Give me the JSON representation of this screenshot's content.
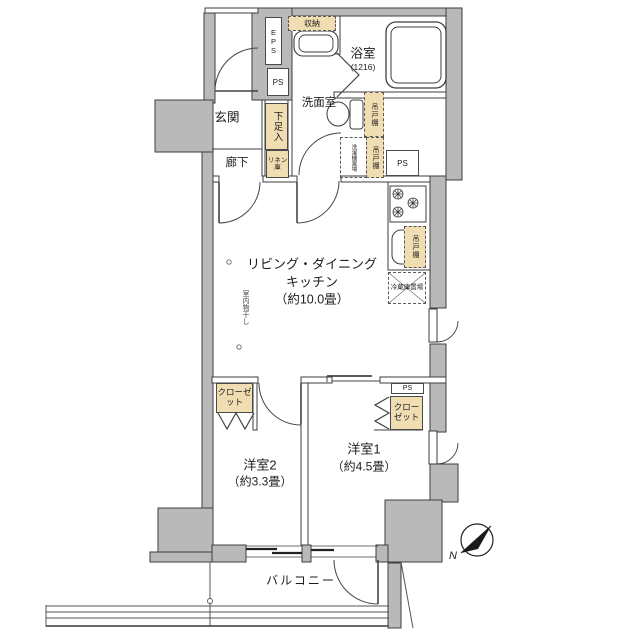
{
  "rooms": {
    "ldk1": "リビング・ダイニング",
    "ldk2": "キッチン",
    "ldk3": "（約10.0畳）",
    "bed1": "洋室1",
    "bed1_size": "（約4.5畳）",
    "bed2": "洋室2",
    "bed2_size": "（約3.3畳）",
    "bath": "浴室",
    "bath_size": "(1216)",
    "washroom": "洗面室",
    "entrance": "玄関",
    "hallway": "廊下",
    "balcony": "バルコニー"
  },
  "labels": {
    "shoe": "下足入",
    "linen": "リネン庫",
    "storage": "収納",
    "hanging": "吊戸棚",
    "washer": "洗濯機置場",
    "fridge": "冷蔵庫置場",
    "drying": "室内物干し",
    "closet": "クローゼット",
    "eps": "EPS",
    "ps": "PS",
    "north": "N"
  },
  "colors": {
    "wall": "#b9b9b9",
    "tan": "#f0ddb2",
    "line": "#3e3e3e"
  }
}
